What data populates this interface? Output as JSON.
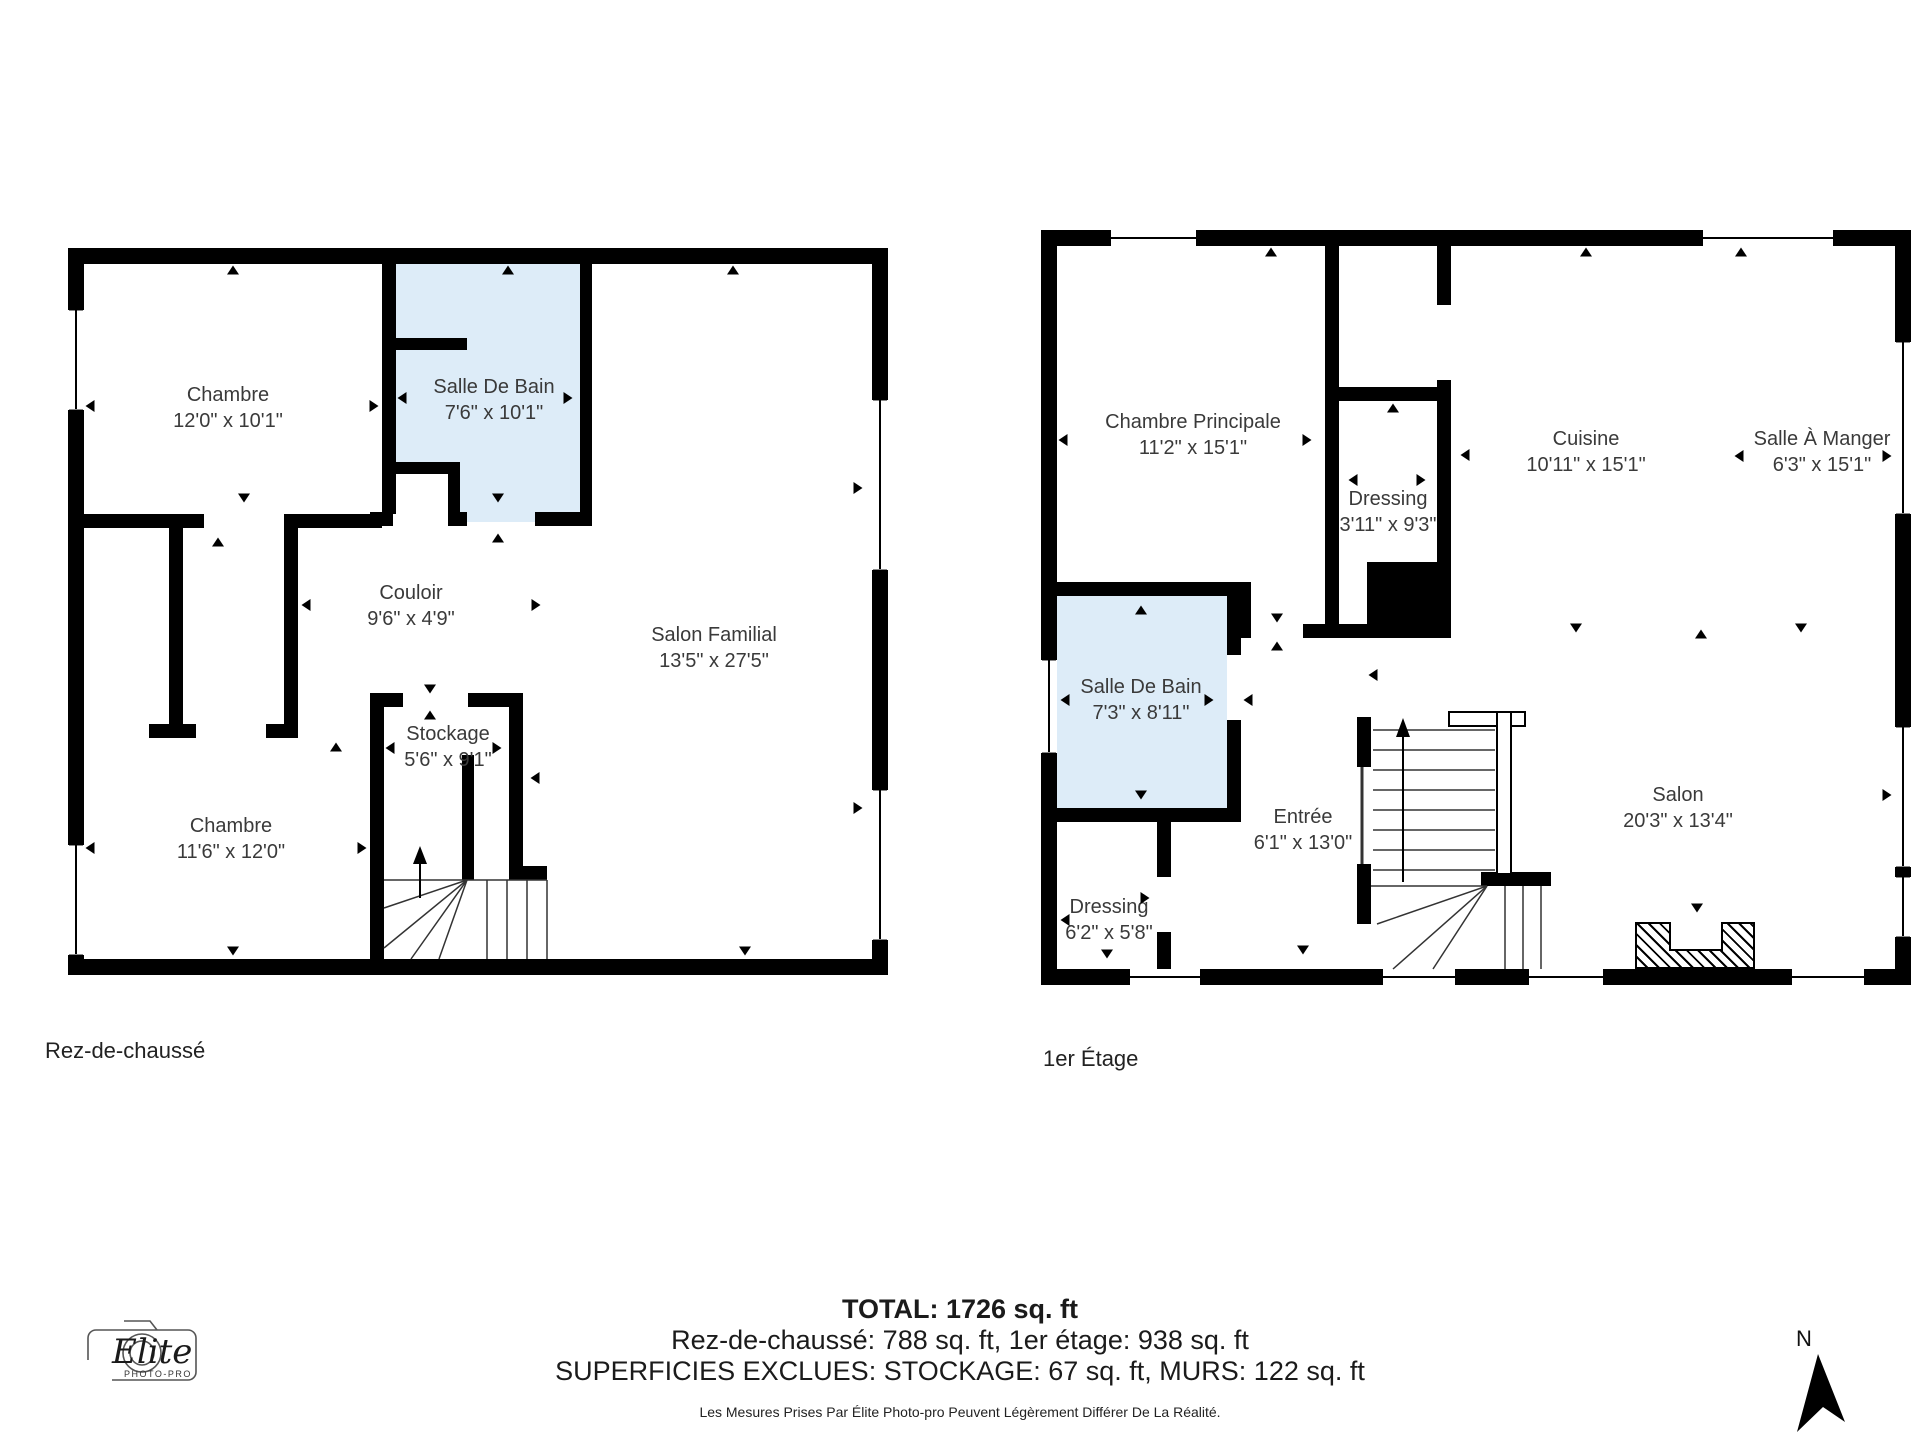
{
  "plans": [
    {
      "title": "Rez-de-chaussé",
      "rooms": [
        {
          "name": "Chambre",
          "dims": "12'0\" x 10'1\""
        },
        {
          "name": "Salle De Bain",
          "dims": "7'6\" x 10'1\""
        },
        {
          "name": "Couloir",
          "dims": "9'6\" x 4'9\""
        },
        {
          "name": "Salon Familial",
          "dims": "13'5\" x 27'5\""
        },
        {
          "name": "Stockage",
          "dims": "5'6\" x 9'1\""
        },
        {
          "name": "Chambre",
          "dims": "11'6\" x 12'0\""
        }
      ]
    },
    {
      "title": "1er Étage",
      "rooms": [
        {
          "name": "Chambre Principale",
          "dims": "11'2\" x 15'1\""
        },
        {
          "name": "Dressing",
          "dims": "3'11\" x 9'3\""
        },
        {
          "name": "Cuisine",
          "dims": "10'11\" x 15'1\""
        },
        {
          "name": "Salle À Manger",
          "dims": "6'3\" x 15'1\""
        },
        {
          "name": "Salle De Bain",
          "dims": "7'3\" x 8'11\""
        },
        {
          "name": "Entrée",
          "dims": "6'1\" x 13'0\""
        },
        {
          "name": "Dressing",
          "dims": "6'2\" x 5'8\""
        },
        {
          "name": "Salon",
          "dims": "20'3\" x 13'4\""
        }
      ]
    }
  ],
  "summary": {
    "total": "TOTAL: 1726 sq. ft",
    "floors": "Rez-de-chaussé: 788 sq. ft, 1er étage: 938 sq. ft",
    "exclusions": "SUPERFICIES EXCLUES: STOCKAGE: 67 sq. ft, MURS: 122 sq. ft",
    "disclaimer": "Les Mesures Prises Par Élite Photo-pro Peuvent Légèrement Différer De La Réalité."
  },
  "compass": {
    "label": "N"
  },
  "logo": {
    "brand": "Elite",
    "sub": "PHOTO-PRO"
  },
  "colors": {
    "wall": "#000000",
    "bath_fill": "#ddecf8",
    "text": "#3a3a3a"
  }
}
